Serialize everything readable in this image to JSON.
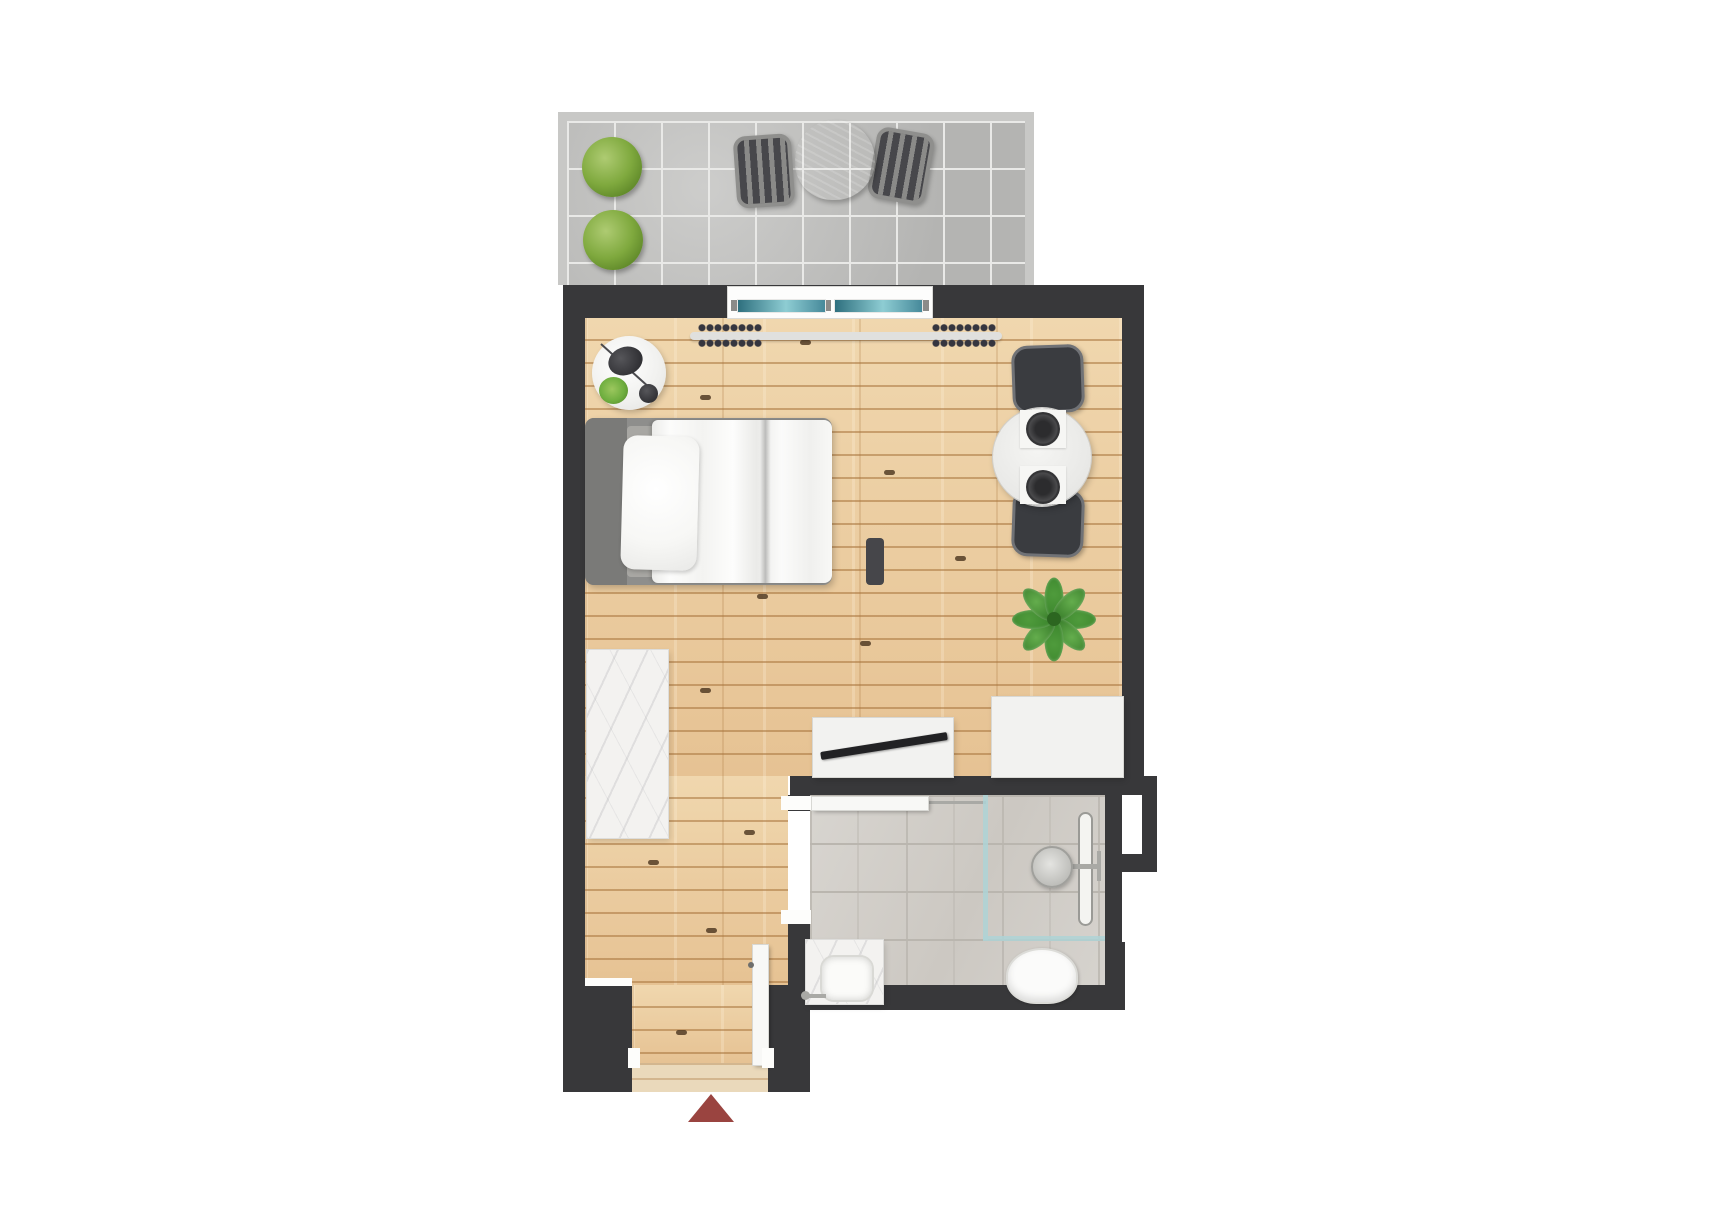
{
  "canvas": {
    "width": 1723,
    "height": 1216
  },
  "plan": {
    "type": "studio-apartment-floor-plan",
    "orientation": "top-down",
    "rooms": [
      {
        "id": "balcony",
        "name": "balcony-terrace"
      },
      {
        "id": "living",
        "name": "living-sleeping-area"
      },
      {
        "id": "bathroom",
        "name": "bathroom"
      },
      {
        "id": "entry",
        "name": "entry-vestibule"
      }
    ],
    "furniture": {
      "balcony": [
        "round-bush-planter",
        "round-bush-planter",
        "bistro-table",
        "bistro-chair",
        "bistro-chair"
      ],
      "living": [
        "sliding-glass-window",
        "curtain-rod-with-rings",
        "bedside-table",
        "table-lamp",
        "small-plant",
        "single-bed-with-duvet-and-pillow",
        "marble-counter",
        "tv-console-with-tv",
        "side-console",
        "potted-plant",
        "round-dining-table-two-place-settings",
        "dining-chair",
        "dining-chair"
      ],
      "bathroom": [
        "hinged-door",
        "walk-in-shower-glass",
        "rain-shower-head",
        "linear-drain",
        "marble-vanity-with-sink",
        "faucet",
        "toilet"
      ],
      "entry": [
        "entry-door-open",
        "entrance-direction-arrow"
      ]
    }
  },
  "colors": {
    "wall": "#38383a",
    "parapet": "#c8c8c6",
    "balconyTile": "#c2c2c0",
    "balconyGrout": "#e9e9e7",
    "wood": "#eccfa5",
    "woodSeam": "#c89a66",
    "woodShade": "#ddb486",
    "threshold": "#ead9bb",
    "bathTile": "#d4d1cc",
    "bathGrout": "#bab6af",
    "marble": "#f3f2f0",
    "marbleVein": "#b9b9bd",
    "furnWhite": "#f2f2f0",
    "furnEdge": "#d8d8d4",
    "glassTealA": "#2e6f7e",
    "glassTealB": "#8ecdd3",
    "showerGlass": "#aed3d6",
    "chairDark": "#3a3c40",
    "chairEdge": "#707276",
    "bedFrame": "#8e8e8c",
    "headboard": "#7a7a78",
    "mattress": "#a8a7a3",
    "pillow": "#f7f7f5",
    "duvet": "#fbfbfa",
    "bushGreen": "#7fa93e",
    "bushGreenDark": "#5c8527",
    "leafGreen": "#4f9b3c",
    "leafGreenDark": "#38822a",
    "arrowRed": "#9a4440",
    "tvBlack": "#222224",
    "knot": "#4a341e",
    "metal": "#a9a9a5",
    "balconyFurn": "#636361",
    "balconyFurnEdge": "#8f8f8d"
  }
}
